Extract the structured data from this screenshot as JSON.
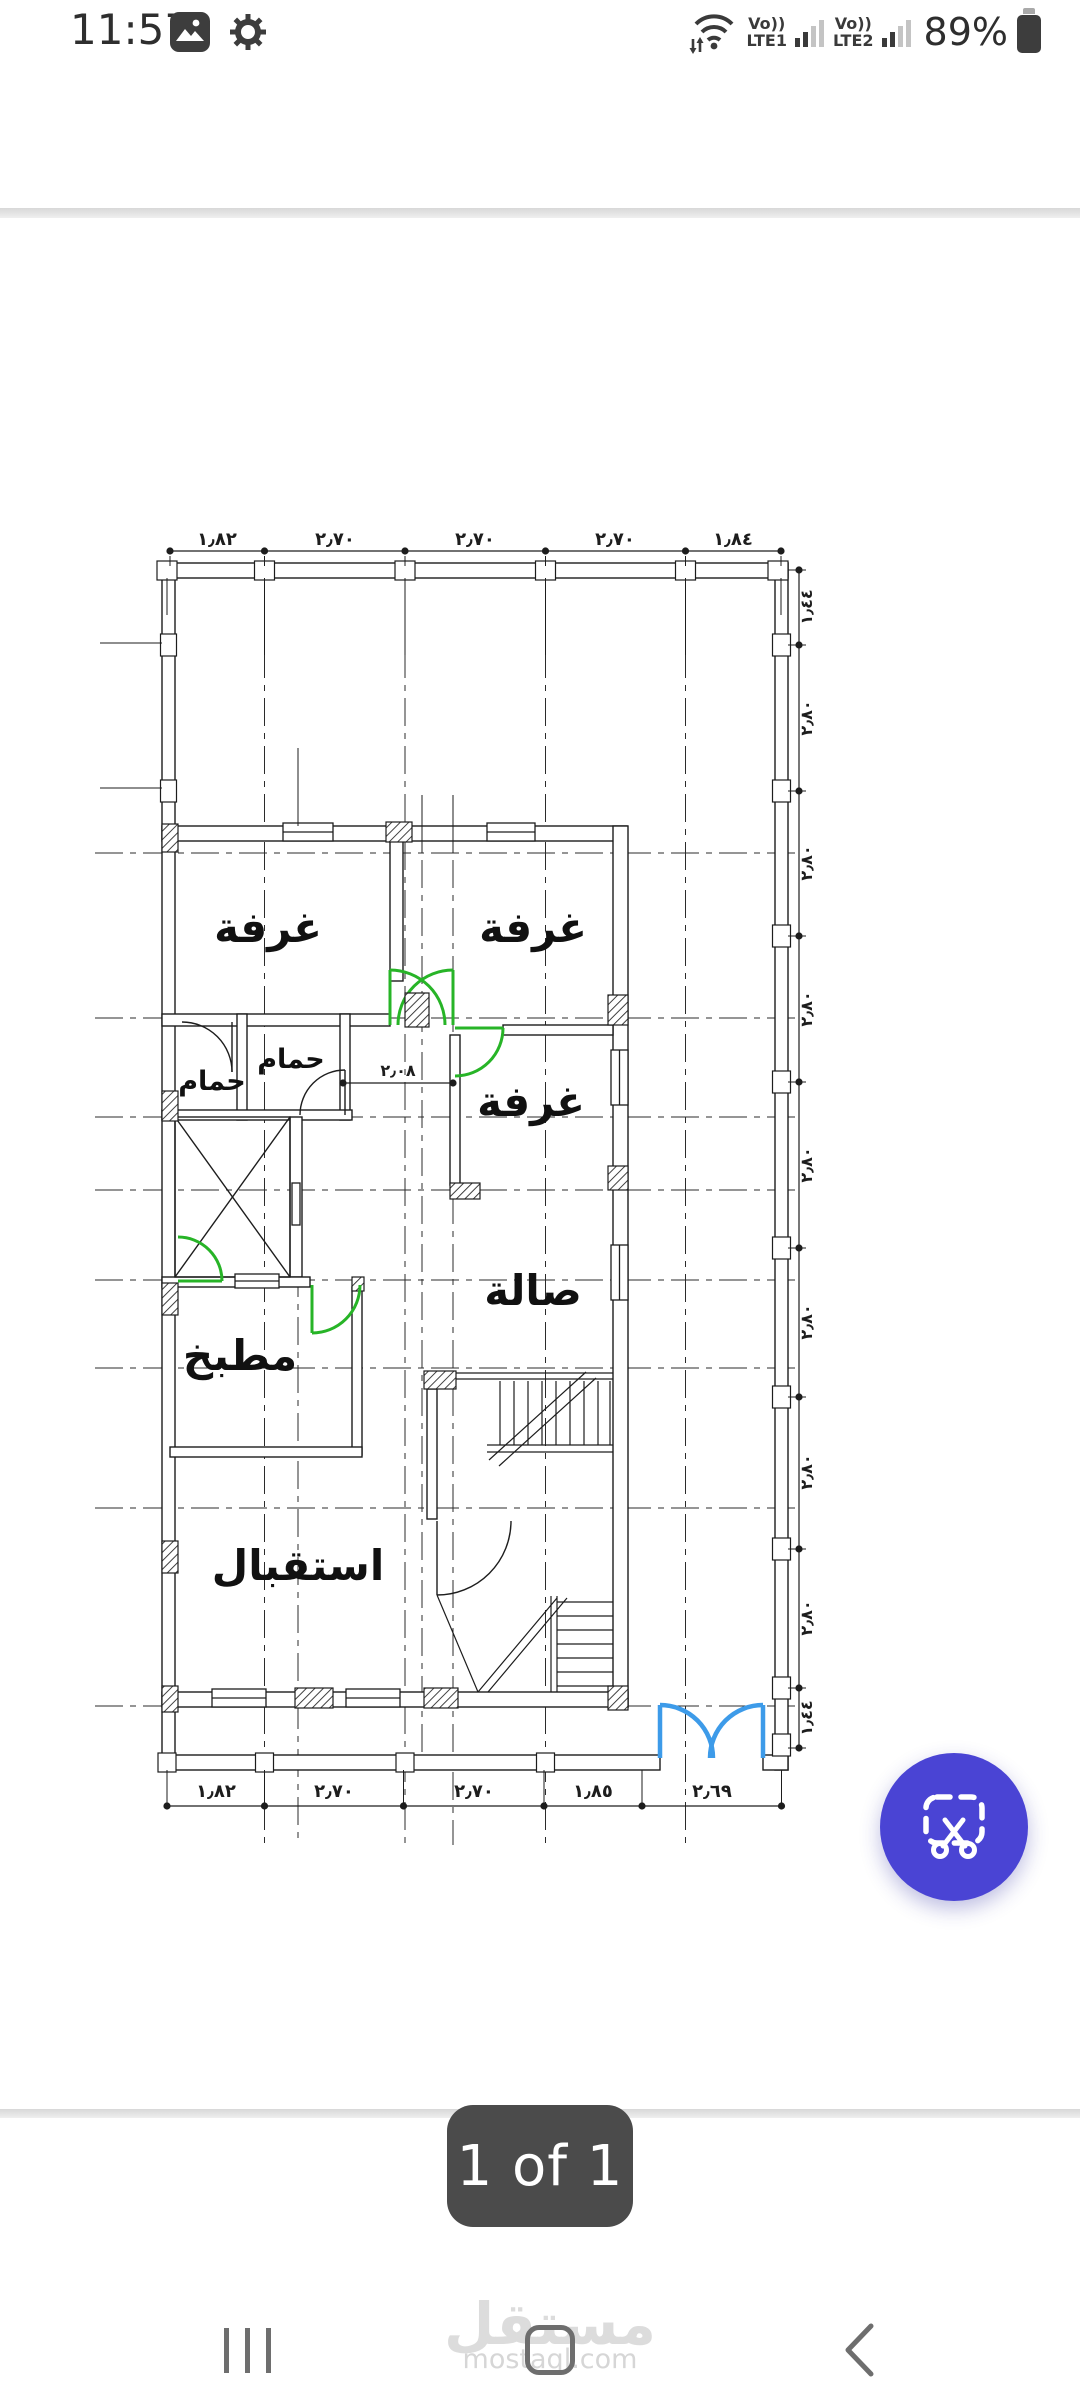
{
  "status_bar": {
    "time": "11:57",
    "battery_percent": "89%",
    "sim1_label": "Vo))",
    "sim1_net": "LTE1",
    "sim2_label": "Vo))",
    "sim2_net": "LTE2"
  },
  "icons": {
    "status": [
      "gallery-icon",
      "gear-icon",
      "wifi-icon",
      "signal-bars-icon",
      "battery-icon"
    ],
    "fab": "crop-scissors-icon",
    "nav": [
      "recents-icon",
      "home-icon",
      "back-icon"
    ]
  },
  "viewer": {
    "page_indicator": "1 of 1"
  },
  "watermark": {
    "logo": "مستقل",
    "site": "mostaql.com"
  },
  "fab": {
    "color": "#4a44d4"
  },
  "plan": {
    "room_labels": {
      "bedroom_tl": "غرفة",
      "bedroom_tr": "غرفة",
      "bedroom_mid": "غرفة",
      "bath_small": "حمام",
      "bath_main": "حمام",
      "kitchen": "مطبخ",
      "hall": "صالة",
      "reception": "استقبال"
    },
    "dims_top": [
      "١٫٨٢",
      "٢٫٧٠",
      "٢٫٧٠",
      "٢٫٧٠",
      "١٫٨٤"
    ],
    "dims_bottom": [
      "١٫٨٢",
      "٢٫٧٠",
      "٢٫٧٠",
      "١٫٨٥",
      "٢٫٦٩"
    ],
    "dims_right": [
      "١٫٤٤",
      "٢٫٨٠",
      "٢٫٨٠",
      "٢٫٨٠",
      "٢٫٨٠",
      "٢٫٨٠",
      "٢٫٨٠",
      "٢٫٨٠",
      "١٫٤٤"
    ],
    "dim_interior": "٢٫٠٨",
    "colors": {
      "line": "#1d1d1d",
      "door_green": "#27b427",
      "door_blue": "#3d9be9"
    }
  }
}
